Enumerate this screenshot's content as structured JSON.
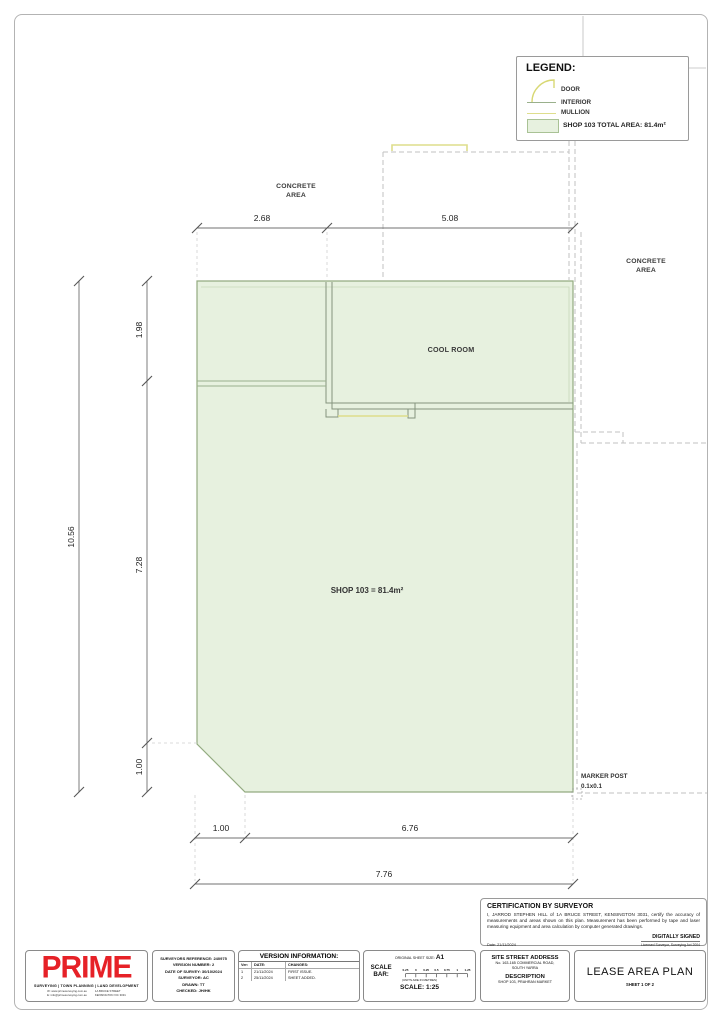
{
  "colors": {
    "shop_fill": "#e7f1df",
    "shop_stroke": "#93ab80",
    "wall": "#84947e",
    "dashed": "#c2c2c2",
    "dimension": "#707070",
    "mullion_yellow": "#dede8c",
    "brand_red": "#e62127"
  },
  "legend": {
    "title": "LEGEND:",
    "door_label": "DOOR",
    "interior_label": "INTERIOR",
    "mullion_label": "MULLION",
    "area_label": "SHOP 103 TOTAL AREA: 81.4m²"
  },
  "plan": {
    "concrete_top_1": "CONCRETE",
    "concrete_top_2": "AREA",
    "concrete_right_1": "CONCRETE",
    "concrete_right_2": "AREA",
    "cool_room": "COOL ROOM",
    "shop_area": "SHOP 103 = 81.4m²",
    "marker_post_1": "MARKER POST",
    "marker_post_2": "0.1x0.1",
    "dims": {
      "top_a": "2.68",
      "top_b": "5.08",
      "left_total": "10.56",
      "left_a": "1.98",
      "left_b": "7.28",
      "left_c": "1.00",
      "bottom_a": "1.00",
      "bottom_b": "6.76",
      "bottom_total": "7.76"
    }
  },
  "certification": {
    "title": "CERTIFICATION BY SURVEYOR",
    "body": "I, JARROD STEPHEN HILL of 1A BRUCE STREET, KENSINGTON 3031, certify the accuracy of measurements and areas shown on this plan. Measurement has been performed by tape and laser measuring equipment and area calculation by computer generated drawings.",
    "date": "Date: 21/11/2024",
    "signed": "DIGITALLY SIGNED",
    "signed_sub": "Licensed Surveyor, Surveying Act 2004"
  },
  "titleblock": {
    "logo": {
      "name": "PRIME",
      "tagline": "SURVEYING | TOWN PLANNING | LAND DEVELOPMENT",
      "contact_w": "W: www.primesurveying.com.au",
      "contact_e": "E: info@primesurveying.com.au",
      "contact_addr1": "1A BRUCE STREET",
      "contact_addr2": "KENSINGTON VIC 3031"
    },
    "reference": {
      "line1": "SURVEYORS REFERENCE: 240975",
      "line2": "VERSION NUMBER: 2",
      "line3": "DATE OF SURVEY: 30/10/2024",
      "line4": "SURVEYOR: AC",
      "line5": "DRAWN: TT",
      "line6": "CHECKED: JH/HK"
    },
    "version_info": {
      "title": "VERSION INFORMATION:",
      "col_ver": "Ver:",
      "col_date": "DATE:",
      "col_changes": "CHANGES:",
      "rows": [
        [
          "1",
          "21/11/2024",
          "FIRST ISSUE."
        ],
        [
          "2",
          "25/11/2024",
          "SHEET ADDED."
        ]
      ]
    },
    "scale": {
      "sheet_size_label": "ORIGINAL SHEET SIZE:",
      "sheet_size": "A1",
      "bar_label": "SCALE BAR:",
      "ticks": [
        "0.25",
        "0",
        "0.25",
        "0.5",
        "0.75",
        "1",
        "1.25"
      ],
      "units": "(UNITS ARE IN METRES)",
      "scale_text": "SCALE: 1:25"
    },
    "address": {
      "title": "SITE STREET ADDRESS",
      "line1": "No. 163-165 COMMERCIAL ROAD,",
      "line2": "SOUTH YARRA",
      "desc_title": "DESCRIPTION",
      "desc": "SHOP 103, PRAHRAN MARKET"
    },
    "title": {
      "main": "LEASE AREA PLAN",
      "sheet": "SHEET 1 OF 2"
    }
  }
}
